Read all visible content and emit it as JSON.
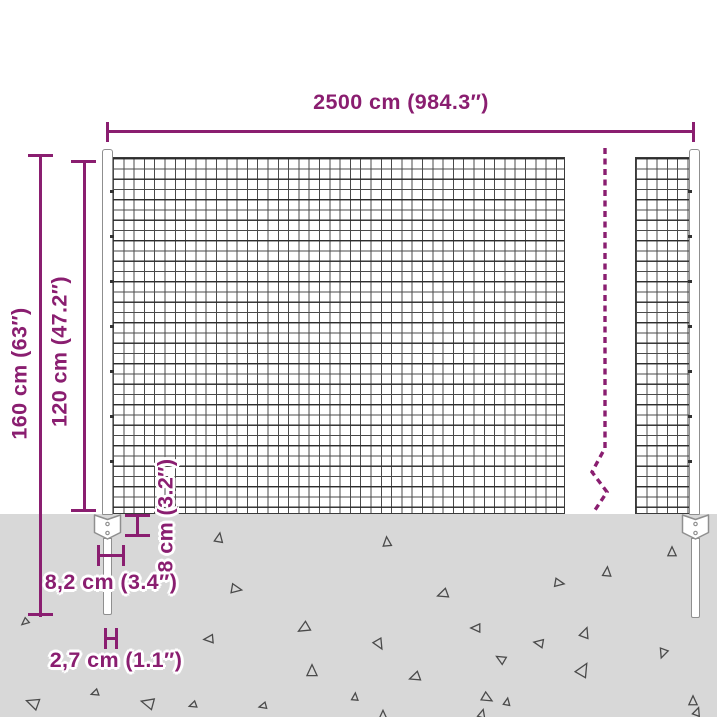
{
  "diagram": {
    "labels": {
      "width": "2500 cm (984.3″)",
      "total_height": "160 cm (63″)",
      "mesh_height": "120 cm (47.2″)",
      "plate_height": "8 cm (3.2″)",
      "plate_width": "8,2 cm (3.4″)",
      "spike_width": "2,7 cm (1.1″)"
    },
    "colors": {
      "accent": "#8a1e70",
      "wire": "#4a4a4a",
      "ground": "#d8d8d8",
      "post-outline": "#8f8f8f"
    },
    "ground": {
      "triangles": [
        {
          "x": 219,
          "y": 538,
          "s": 9,
          "r": 10
        },
        {
          "x": 387,
          "y": 542,
          "s": 9,
          "r": 355
        },
        {
          "x": 672,
          "y": 552,
          "s": 9,
          "r": 0
        },
        {
          "x": 607,
          "y": 572,
          "s": 9,
          "r": 5
        },
        {
          "x": 559,
          "y": 583,
          "s": 9,
          "r": 100
        },
        {
          "x": 236,
          "y": 589,
          "s": 10,
          "r": 100
        },
        {
          "x": 443,
          "y": 594,
          "s": 10,
          "r": 250
        },
        {
          "x": 158,
          "y": 581,
          "s": 6,
          "r": 210
        },
        {
          "x": 25,
          "y": 622,
          "s": 7,
          "r": 230
        },
        {
          "x": 304,
          "y": 628,
          "s": 11,
          "r": 240
        },
        {
          "x": 476,
          "y": 628,
          "s": 9,
          "r": 270
        },
        {
          "x": 585,
          "y": 633,
          "s": 10,
          "r": 20
        },
        {
          "x": 209,
          "y": 639,
          "s": 9,
          "r": 265
        },
        {
          "x": 539,
          "y": 643,
          "s": 9,
          "r": 280
        },
        {
          "x": 379,
          "y": 644,
          "s": 10,
          "r": 150
        },
        {
          "x": 663,
          "y": 653,
          "s": 9,
          "r": 200
        },
        {
          "x": 501,
          "y": 659,
          "s": 9,
          "r": 300
        },
        {
          "x": 583,
          "y": 670,
          "s": 13,
          "r": 30
        },
        {
          "x": 312,
          "y": 671,
          "s": 11,
          "r": 0
        },
        {
          "x": 415,
          "y": 677,
          "s": 10,
          "r": 250
        },
        {
          "x": 95,
          "y": 693,
          "s": 7,
          "r": 250
        },
        {
          "x": 355,
          "y": 697,
          "s": 7,
          "r": 5
        },
        {
          "x": 487,
          "y": 698,
          "s": 10,
          "r": 120
        },
        {
          "x": 693,
          "y": 701,
          "s": 9,
          "r": 0
        },
        {
          "x": 33,
          "y": 703,
          "s": 12,
          "r": 290
        },
        {
          "x": 148,
          "y": 703,
          "s": 12,
          "r": 285
        },
        {
          "x": 193,
          "y": 705,
          "s": 7,
          "r": 250
        },
        {
          "x": 263,
          "y": 706,
          "s": 7,
          "r": 255
        },
        {
          "x": 507,
          "y": 702,
          "s": 7,
          "r": 10
        },
        {
          "x": 383,
          "y": 715,
          "s": 8,
          "r": 0
        },
        {
          "x": 482,
          "y": 714,
          "s": 8,
          "r": 15
        },
        {
          "x": 697,
          "y": 712,
          "s": 8,
          "r": 20
        }
      ]
    }
  }
}
